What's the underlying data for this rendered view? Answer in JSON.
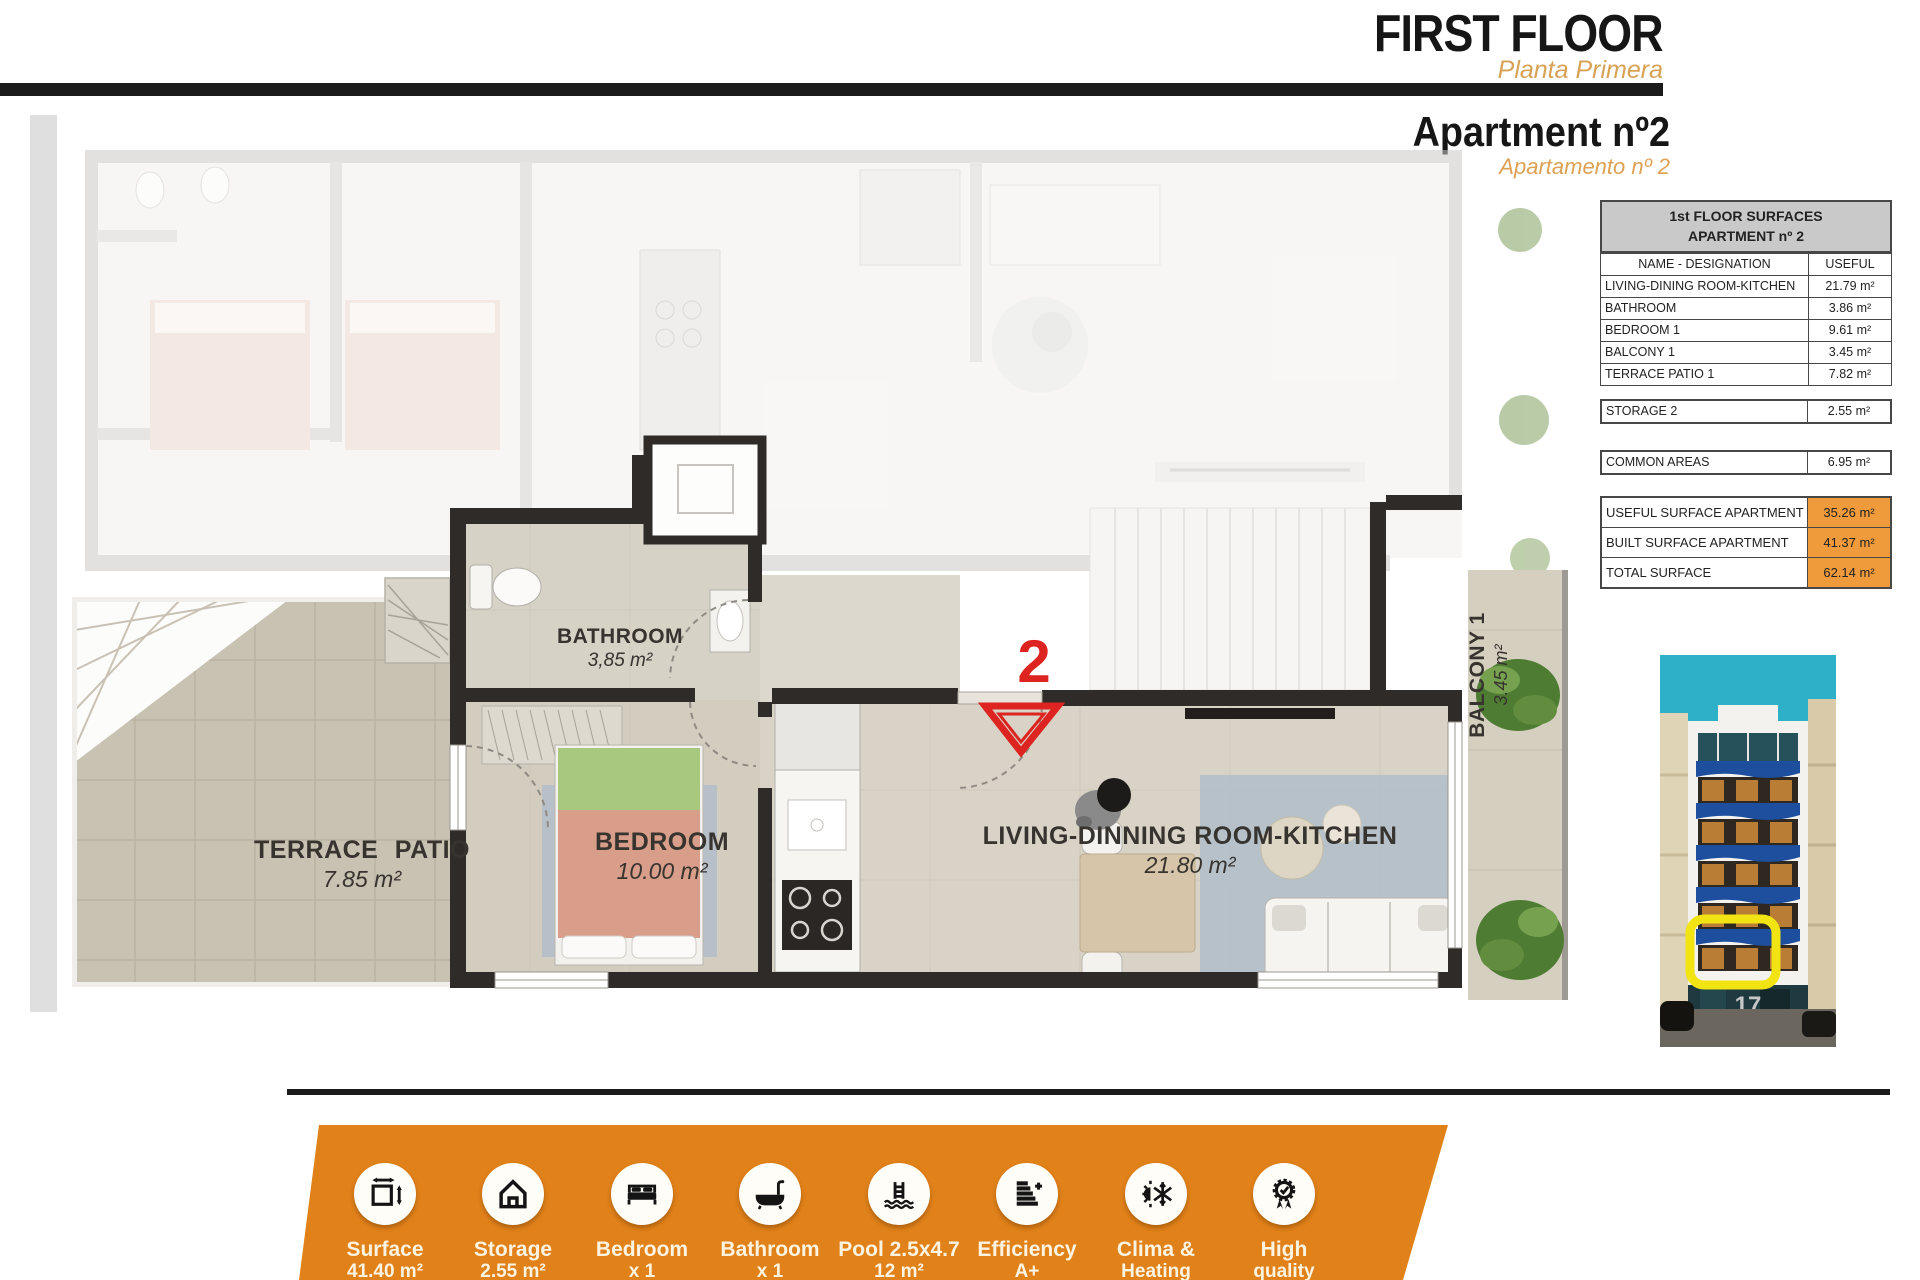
{
  "header": {
    "title": "FIRST FLOOR",
    "subtitle": "Planta Primera",
    "apartment_title": "Apartment nº2",
    "apartment_subtitle": "Apartamento nº 2"
  },
  "surfaces_table": {
    "title_line1": "1st FLOOR SURFACES",
    "title_line2": "APARTMENT nº 2",
    "columns": {
      "name": "NAME - DESIGNATION",
      "useful": "USEFUL"
    },
    "rows": [
      {
        "name": "LIVING-DINING ROOM-KITCHEN",
        "value": "21.79 m²"
      },
      {
        "name": "BATHROOM",
        "value": "3.86 m²"
      },
      {
        "name": "BEDROOM 1",
        "value": "9.61 m²"
      },
      {
        "name": "BALCONY 1",
        "value": "3.45 m²"
      },
      {
        "name": "TERRACE PATIO 1",
        "value": "7.82 m²"
      }
    ],
    "storage_row": {
      "name": "STORAGE 2",
      "value": "2.55 m²"
    },
    "common_row": {
      "name": "COMMON AREAS",
      "value": "6.95 m²"
    },
    "summary_rows": [
      {
        "name": "USEFUL SURFACE APARTMENT",
        "value": "35.26 m²"
      },
      {
        "name": "BUILT SURFACE APARTMENT",
        "value": "41.37 m²"
      },
      {
        "name": "TOTAL SURFACE",
        "value": "62.14 m²"
      }
    ],
    "highlight_color": "#F09B3B"
  },
  "floor_plan": {
    "unit_marker": "2",
    "marker_color": "#DD2420",
    "rooms": [
      {
        "name": "BATHROOM",
        "area": "3,85 m²"
      },
      {
        "name": "BEDROOM",
        "area": "10.00 m²"
      },
      {
        "name": "LIVING-DINNING ROOM-KITCHEN",
        "area": "21.80 m²"
      },
      {
        "name": "TERRACE PATIO",
        "area": "7.85 m²"
      },
      {
        "name": "BALCONY 1",
        "area": "3.45 m²"
      }
    ]
  },
  "building_photo": {
    "street_number": "17",
    "highlight_color": "#F2E412"
  },
  "features_banner": {
    "bg_color": "#E08119",
    "items": [
      {
        "icon": "surface-measure-icon",
        "line1": "Surface",
        "line2": "41.40 m²"
      },
      {
        "icon": "storage-house-icon",
        "line1": "Storage",
        "line2": "2.55 m²"
      },
      {
        "icon": "bed-icon",
        "line1": "Bedroom",
        "line2": "x 1"
      },
      {
        "icon": "bathtub-icon",
        "line1": "Bathroom",
        "line2": "x 1"
      },
      {
        "icon": "pool-ladder-icon",
        "line1": "Pool 2.5x4.7",
        "line2": "12 m²"
      },
      {
        "icon": "energy-efficiency-icon",
        "line1": "Efficiency",
        "line2": "A+"
      },
      {
        "icon": "sun-snowflake-icon",
        "line1": "Clima &",
        "line2": "Heating"
      },
      {
        "icon": "quality-badge-icon",
        "line1": "High",
        "line2": "quality"
      }
    ]
  }
}
